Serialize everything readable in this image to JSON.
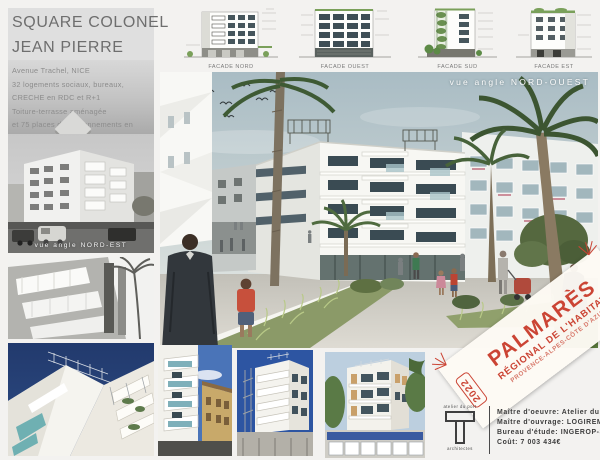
{
  "board": {
    "title_line1": "SQUARE COLONEL",
    "title_line2": "JEAN PIERRE",
    "description_lines": [
      "Avenue Trachel, NICE",
      "32 logements sociaux, bureaux,",
      "CRECHE en RDC et R+1",
      "Toiture-terrasse aménagée",
      "et 75 places de stationnements en sous-sol"
    ]
  },
  "facades": [
    {
      "label": "FACADE NORD"
    },
    {
      "label": "FACADE OUEST"
    },
    {
      "label": "FACADE SUD"
    },
    {
      "label": "FACADE EST"
    }
  ],
  "captions": {
    "photo_northeast": "vue angle NORD-EST",
    "render_northwest": "vue angle NORD-OUEST"
  },
  "award": {
    "title": "PALMARÈS",
    "subtitle": "RÉGIONAL DE L'HABITAT",
    "region": "PROVENCE-ALPES-CÔTE D'AZUR",
    "year": "2022",
    "accent_color": "#cb4434"
  },
  "logo": {
    "top": "atelier du port",
    "bottom": "architectes"
  },
  "credits": {
    "lines": [
      "Maître d'oeuvre: Atelier du Port",
      "Maître d'ouvrage: LOGIREM",
      "Bureau d'étude: INGEROP-SLK",
      "Coût: 7 003 434€"
    ]
  }
}
